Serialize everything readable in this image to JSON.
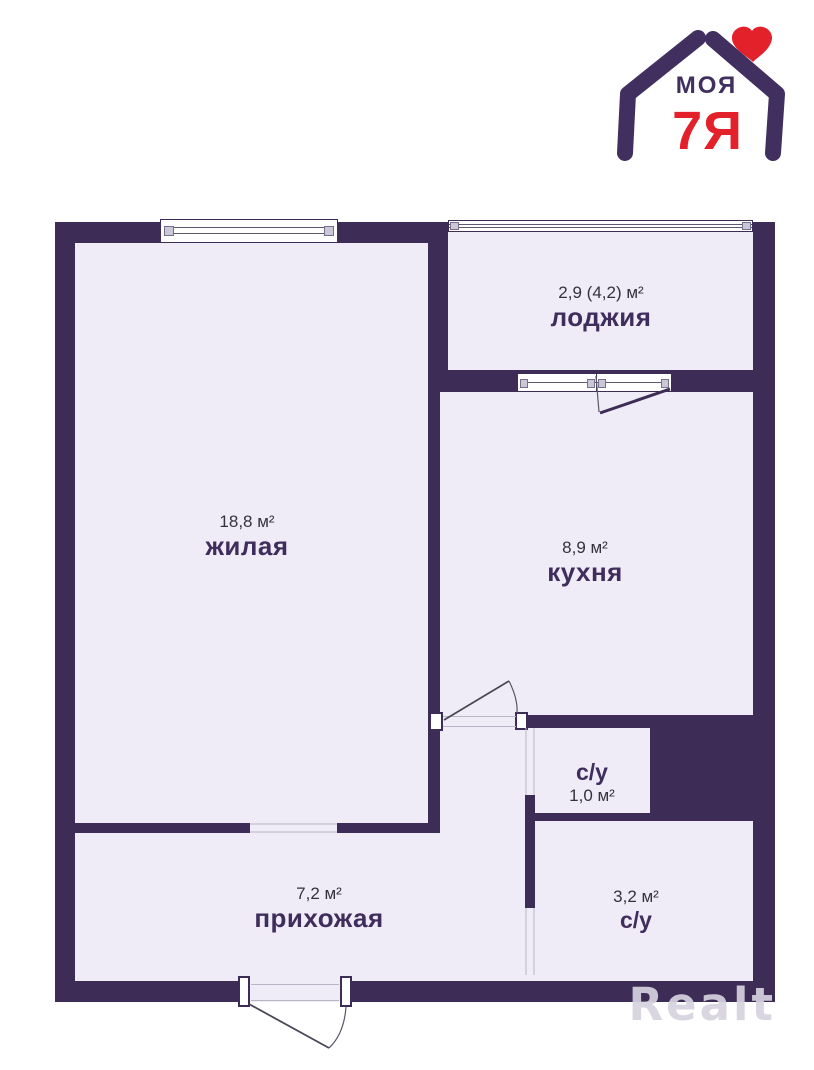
{
  "logo": {
    "brand_top": "МОЯ",
    "brand_bottom": "7Я",
    "icon": "house-of-hands-with-heart-icon"
  },
  "watermark": "Realt",
  "colors": {
    "wall": "#3d2c56",
    "floor": "#efecf7",
    "logo_purple": "#41305f",
    "logo_red": "#e3212b",
    "room_name_text": "#3f2d5c",
    "area_text": "#34323e"
  },
  "rooms": [
    {
      "id": "loggia",
      "area": "2,9 (4,2) м²",
      "name": "лоджия"
    },
    {
      "id": "living",
      "area": "18,8 м²",
      "name": "жилая"
    },
    {
      "id": "kitchen",
      "area": "8,9 м²",
      "name": "кухня"
    },
    {
      "id": "wc-small",
      "area": "1,0 м²",
      "name": "с/у"
    },
    {
      "id": "hallway",
      "area": "7,2 м²",
      "name": "прихожая"
    },
    {
      "id": "wc-big",
      "area": "3,2 м²",
      "name": "с/у"
    }
  ]
}
